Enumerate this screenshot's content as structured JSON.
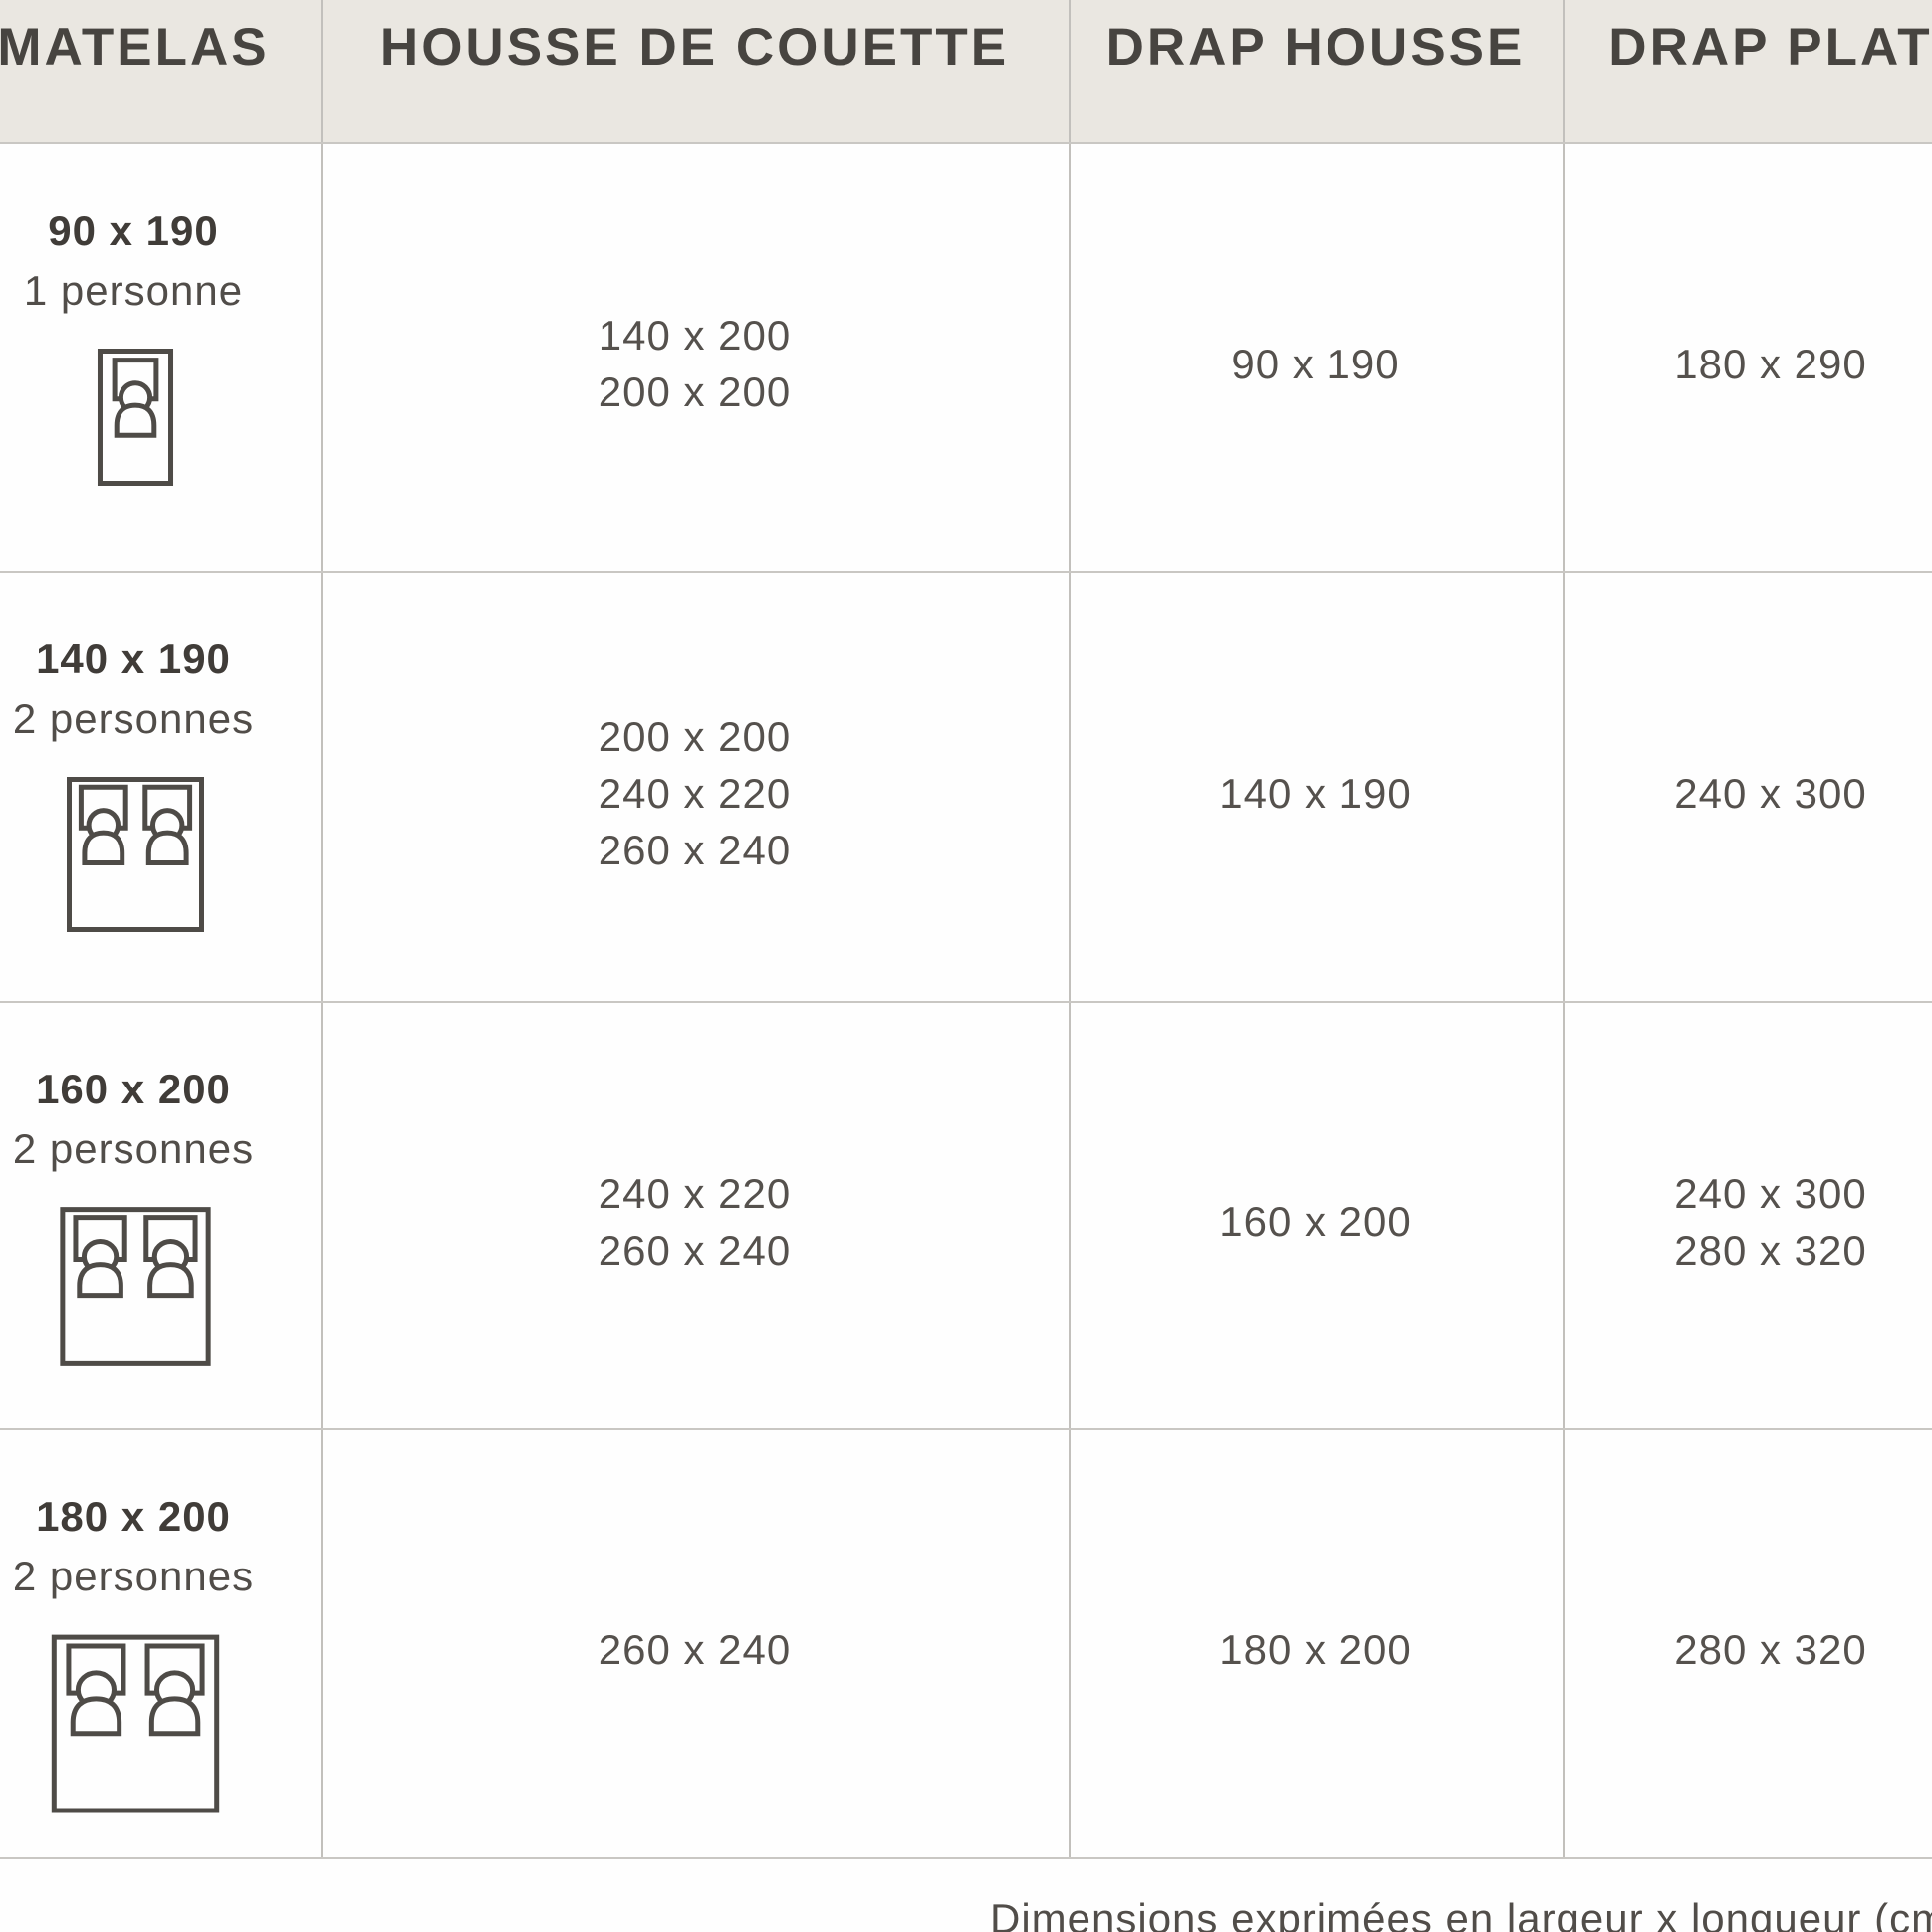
{
  "colors": {
    "header_bg": "#eae7e1",
    "grid_line": "#c6c4c0",
    "header_text": "#474440",
    "title_text": "#403c38",
    "body_text": "#55514d",
    "icon_stroke": "#4e4b47",
    "cell_bg": "#fefefe"
  },
  "table": {
    "headers": [
      "MATELAS",
      "HOUSSE DE COUETTE",
      "DRAP HOUSSE",
      "DRAP PLAT"
    ],
    "rows": [
      {
        "matelas": {
          "size": "90 x 190",
          "capacity": "1 personne",
          "icon": "single-bed"
        },
        "housse_de_couette": [
          "140 x 200",
          "200 x 200"
        ],
        "drap_housse": [
          "90 x 190"
        ],
        "drap_plat": [
          "180 x 290"
        ]
      },
      {
        "matelas": {
          "size": "140 x 190",
          "capacity": "2 personnes",
          "icon": "double-bed"
        },
        "housse_de_couette": [
          "200 x 200",
          "240 x 220",
          "260 x 240"
        ],
        "drap_housse": [
          "140 x 190"
        ],
        "drap_plat": [
          "240 x 300"
        ]
      },
      {
        "matelas": {
          "size": "160 x 200",
          "capacity": "2 personnes",
          "icon": "double-bed"
        },
        "housse_de_couette": [
          "240 x 220",
          "260 x 240"
        ],
        "drap_housse": [
          "160 x 200"
        ],
        "drap_plat": [
          "240 x 300",
          "280 x 320"
        ]
      },
      {
        "matelas": {
          "size": "180 x 200",
          "capacity": "2 personnes",
          "icon": "double-bed"
        },
        "housse_de_couette": [
          "260 x 240"
        ],
        "drap_housse": [
          "180 x 200"
        ],
        "drap_plat": [
          "280 x 320"
        ]
      }
    ],
    "footnote": "Dimensions exprimées en largeur x longueur (cm)"
  }
}
